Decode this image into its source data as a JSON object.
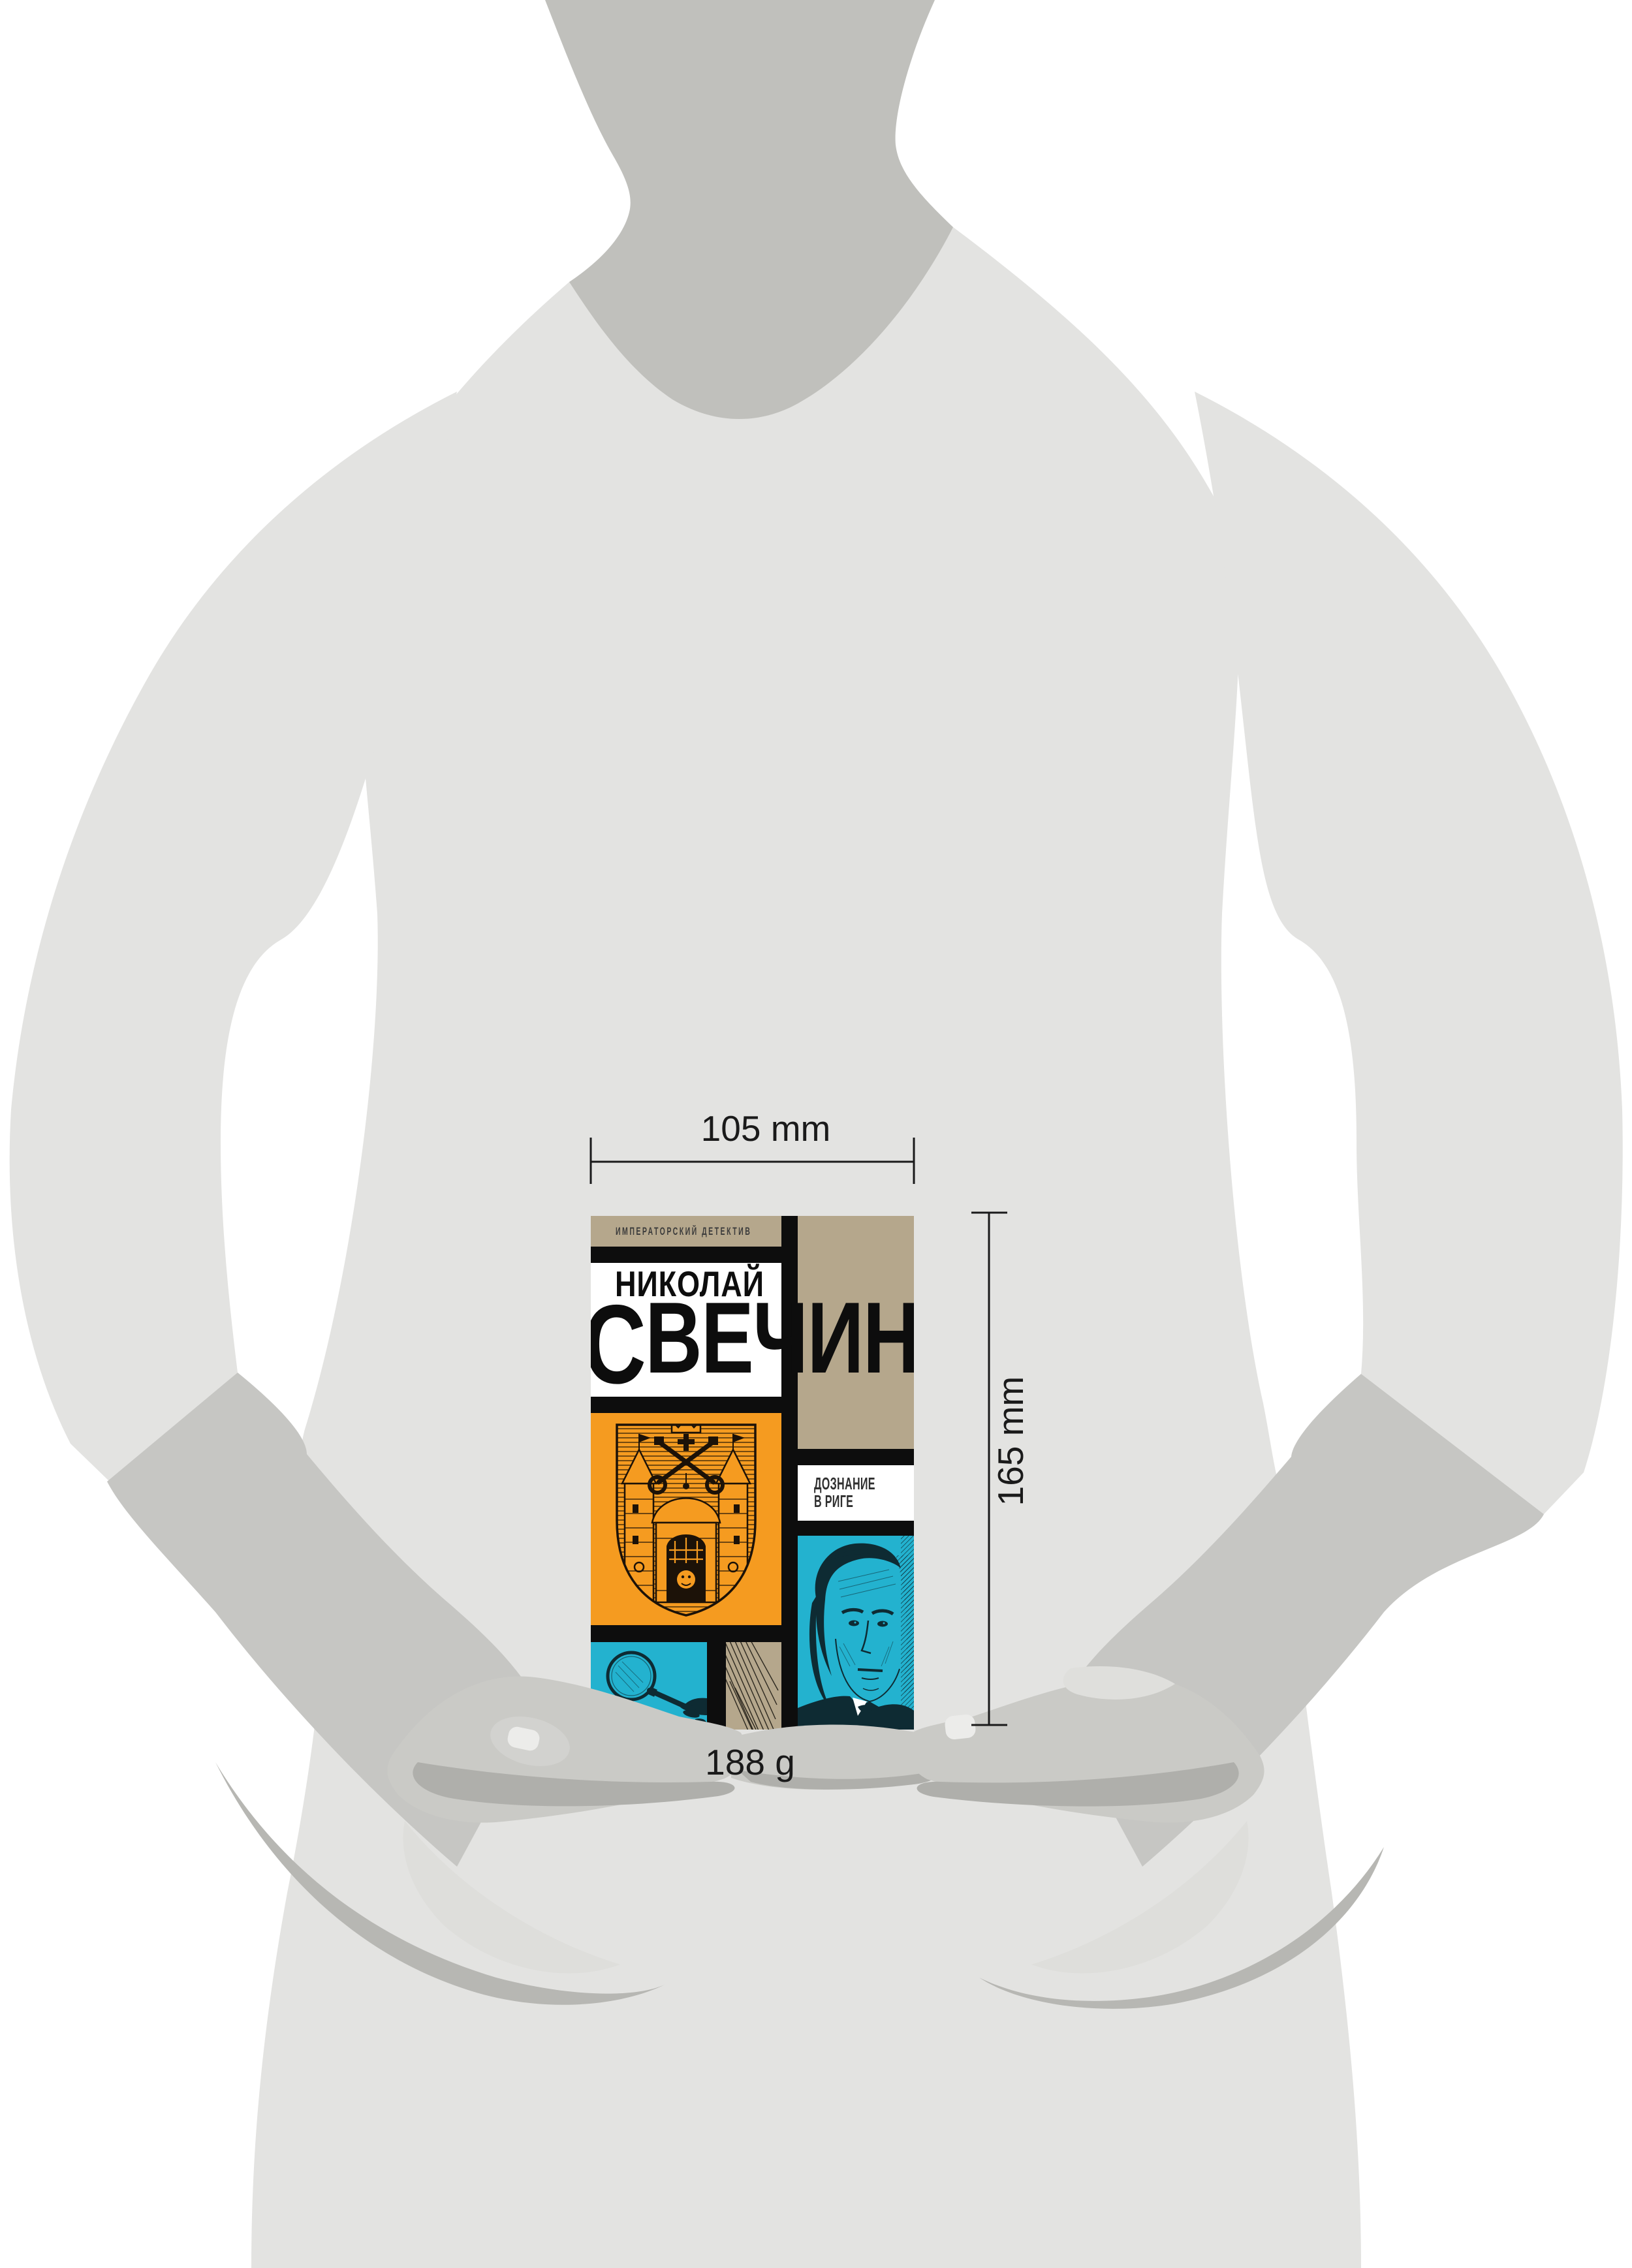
{
  "dimensions": {
    "width_label": "105 mm",
    "height_label": "165 mm",
    "weight_label": "188 g"
  },
  "book": {
    "series_title": "ИМПЕРАТОРСКИЙ ДЕТЕКТИВ",
    "author_first_name": "НИКОЛАЙ",
    "author_surname_initial": "С",
    "author_surname_rest": "ВЕЧИН",
    "title_line1": "ДОЗНАНИЕ",
    "title_line2": "В РИГЕ",
    "cover_colors": {
      "grid_black": "#0D0D0D",
      "tan": "#B5A78C",
      "orange": "#F59B20",
      "cyan": "#23B2CF",
      "white": "#FFFFFF",
      "engraving_ink": "#0E2B33"
    },
    "artwork": [
      "riga-coat-of-arms",
      "detective-portrait",
      "magnifying-glass",
      "crosshatch-texture"
    ]
  },
  "silhouette_colors": {
    "body": "#E3E3E1",
    "neck": "#C0C0BC",
    "forearm": "#C6C6C3",
    "hand": "#CACAC6",
    "shadow": "#AFAFAB",
    "nail": "#ECECEA"
  }
}
